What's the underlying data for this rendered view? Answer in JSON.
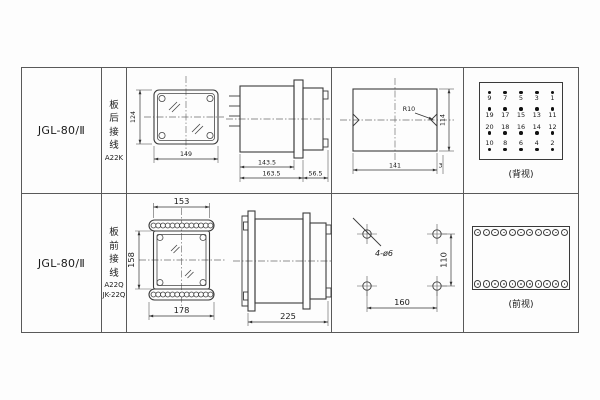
{
  "rows": [
    {
      "model": "JGL-80/Ⅱ",
      "wiring_chars": [
        "板",
        "后",
        "接",
        "线"
      ],
      "wiring_codes": [
        "A22K"
      ],
      "front_view": {
        "height": "124",
        "width": "149"
      },
      "side_view": {
        "body": "143.5",
        "total": "163.5",
        "rear": "56.5"
      },
      "cutout": {
        "radius": "R10",
        "width": "141",
        "height": "114",
        "edge": "3"
      },
      "rear_panel": {
        "caption": "(背视)",
        "terminal_rows": [
          {
            "dots": "above",
            "numbers": [
              "9",
              "7",
              "5",
              "3",
              "1"
            ]
          },
          {
            "dots": "above",
            "numbers": [
              "19",
              "17",
              "15",
              "13",
              "11"
            ]
          },
          {
            "dots": "below",
            "numbers": [
              "20",
              "18",
              "16",
              "14",
              "12"
            ]
          },
          {
            "dots": "below",
            "numbers": [
              "10",
              "8",
              "6",
              "4",
              "2"
            ]
          }
        ]
      }
    },
    {
      "model": "JGL-80/Ⅱ",
      "wiring_chars": [
        "板",
        "前",
        "接",
        "线"
      ],
      "wiring_codes": [
        "A22Q",
        "JK-22Q"
      ],
      "front_view": {
        "top": "153",
        "height": "158",
        "bottom": "178"
      },
      "side_view": {
        "total": "225"
      },
      "drill_plan": {
        "label": "4-ø6",
        "height": "110",
        "width": "160"
      },
      "front_panel": {
        "caption": "(前视)",
        "terminals_per_row": 11
      }
    }
  ]
}
